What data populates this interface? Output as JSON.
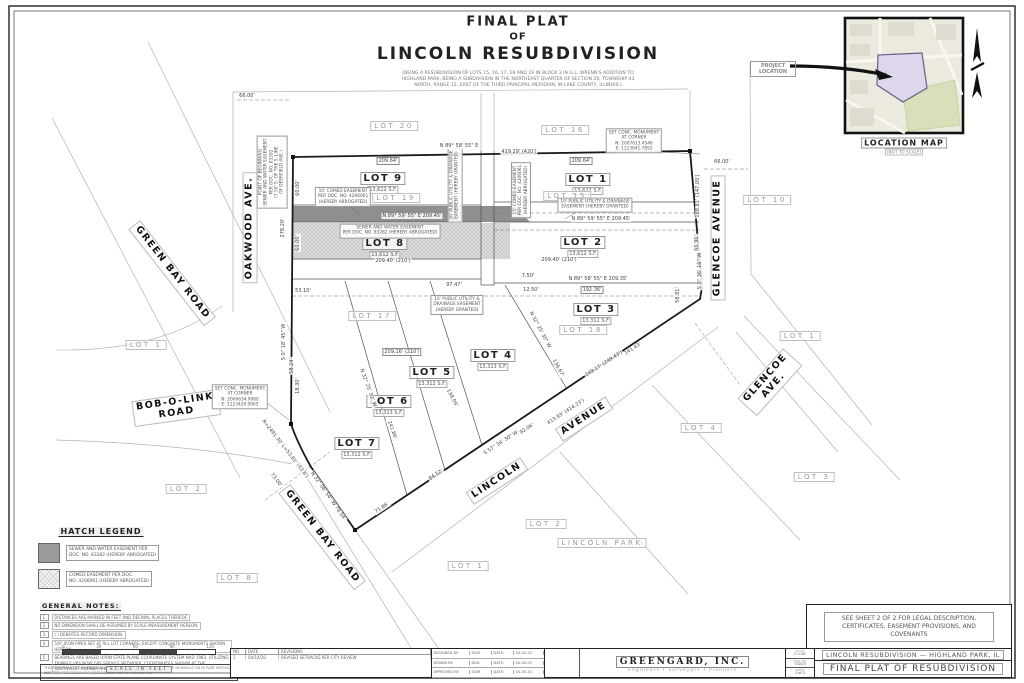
{
  "sheet": {
    "title_lines": [
      "FINAL PLAT",
      "OF",
      "LINCOLN RESUBDIVISION"
    ],
    "subtitle": "(BEING A RESUBDIVISION OF LOTS 15, 16, 17, 18 AND 19 IN BLOCK 3 IN G.L. WRENN'S ADDITION TO HIGHLAND PARK, BEING A SUBDIVISION IN THE NORTHEAST QUARTER OF SECTION 26, TOWNSHIP 43 NORTH, RANGE 12, EAST OF THE THIRD PRINCIPAL MERIDIAN, IN LAKE COUNTY, ILLINOIS.)"
  },
  "location_map": {
    "pointer": "PROJECT LOCATION",
    "caption": "LOCATION MAP",
    "scale_note": "(NOT TO SCALE)"
  },
  "plat": {
    "lots": [
      {
        "name": "LOT 9",
        "area": "13,622 S.F.",
        "x": 383,
        "y": 180
      },
      {
        "name": "LOT 1",
        "area": "13,622 S.F.",
        "x": 588,
        "y": 181
      },
      {
        "name": "LOT 8",
        "area": "13,612 S.F.",
        "x": 385,
        "y": 245
      },
      {
        "name": "LOT 2",
        "area": "13,612 S.F.",
        "x": 583,
        "y": 244
      },
      {
        "name": "LOT 3",
        "area": "13,312 S.F.",
        "x": 596,
        "y": 311
      },
      {
        "name": "LOT 4",
        "area": "13,313 S.F.",
        "x": 493,
        "y": 357
      },
      {
        "name": "LOT 5",
        "area": "13,312 S.F.",
        "x": 432,
        "y": 374
      },
      {
        "name": "LOT 6",
        "area": "13,313 S.F.",
        "x": 389,
        "y": 403
      },
      {
        "name": "LOT 7",
        "area": "13,312 S.F.",
        "x": 357,
        "y": 445
      }
    ],
    "old_lots": [
      {
        "t": "LOT 20",
        "x": 394,
        "y": 126
      },
      {
        "t": "LOT 16",
        "x": 565,
        "y": 130
      },
      {
        "t": "LOT 19",
        "x": 396,
        "y": 198
      },
      {
        "t": "LOT 15",
        "x": 567,
        "y": 196
      },
      {
        "t": "LOT 18",
        "x": 583,
        "y": 330
      },
      {
        "t": "LOT 17",
        "x": 372,
        "y": 316
      }
    ],
    "adjacent_lots": [
      {
        "t": "LOT 10",
        "x": 767,
        "y": 200
      },
      {
        "t": "LOT 1",
        "x": 800,
        "y": 336
      },
      {
        "t": "LOT 4",
        "x": 701,
        "y": 428
      },
      {
        "t": "LOT 3",
        "x": 814,
        "y": 477
      },
      {
        "t": "LOT 1",
        "x": 146,
        "y": 345
      },
      {
        "t": "LOT 2",
        "x": 186,
        "y": 489
      },
      {
        "t": "LOT 2",
        "x": 546,
        "y": 524
      },
      {
        "t": "LOT 1",
        "x": 468,
        "y": 566
      },
      {
        "t": "LOT 8",
        "x": 237,
        "y": 578
      },
      {
        "t": "LINCOLN  PARK",
        "x": 602,
        "y": 543
      }
    ],
    "streets": [
      {
        "lines": [
          "OAKWOOD AVE."
        ],
        "x": 250,
        "y": 228,
        "r": -90
      },
      {
        "lines": [
          "GREEN BAY ROAD"
        ],
        "x": 172,
        "y": 273,
        "r": 52
      },
      {
        "lines": [
          "BOB-O-LINK",
          "ROAD"
        ],
        "x": 176,
        "y": 408,
        "r": -8
      },
      {
        "lines": [
          "GREEN BAY ROAD"
        ],
        "x": 322,
        "y": 537,
        "r": 52
      },
      {
        "lines": [
          "LINCOLN"
        ],
        "x": 497,
        "y": 481,
        "r": -33
      },
      {
        "lines": [
          "AVENUE"
        ],
        "x": 584,
        "y": 419,
        "r": -33
      },
      {
        "lines": [
          "GLENCOE AVENUE"
        ],
        "x": 718,
        "y": 238,
        "r": -90
      },
      {
        "lines": [
          "GLENCOE",
          "AVE."
        ],
        "x": 770,
        "y": 382,
        "r": -48
      }
    ],
    "notes": [
      {
        "lines": [
          "10' COMED EASEMENT",
          "PER DOC. NO. 4206061",
          "(HEREBY ABROGATED)"
        ],
        "x": 343,
        "y": 197
      },
      {
        "lines": [
          "SEWER AND WATER EASEMENT",
          "PER DOC. NO. 83282 (HEREBY ABROGATED)"
        ],
        "x": 390,
        "y": 231
      },
      {
        "lines": [
          "15' COMED EASEMENT",
          "PER DOC. NO. 4206061",
          "(HEREBY ABROGATED)"
        ],
        "x": 521,
        "y": 190,
        "r": -90
      },
      {
        "lines": [
          "10' PUBLIC UTILITY & DRAINAGE",
          "EASEMENT (HEREBY GRANTED)"
        ],
        "x": 595,
        "y": 205
      },
      {
        "lines": [
          "10' PUBLIC UTILITY &",
          "DRAINAGE EASEMENT",
          "(HEREBY GRANTED)"
        ],
        "x": 457,
        "y": 305
      },
      {
        "lines": [
          "20' PUBLIC UTILITY & DRAINAGE",
          "EASEMENT (HEREBY GRANTED)"
        ],
        "x": 455,
        "y": 185,
        "r": -90
      },
      {
        "lines": [
          "SET CONC. MONUMENT",
          "AT CORNER",
          "N: 2007613.4546",
          "E: 1123941.7852"
        ],
        "x": 634,
        "y": 141
      },
      {
        "lines": [
          "SET CONC. MONUMENT",
          "AT CORNER",
          "N: 2006634.9060",
          "E: 1123420.0065"
        ],
        "x": 240,
        "y": 397
      },
      {
        "lines": [
          "POINT OF BEGINNING",
          "SEWER AND WATER EASEMENT",
          "PER DOC. NO. 83282",
          "(7.50' S. OF THE S. LINE",
          "OF DEERFIELD AVE.)"
        ],
        "x": 272,
        "y": 172,
        "r": -90
      }
    ],
    "dims": [
      {
        "t": "66.00'",
        "x": 247,
        "y": 96
      },
      {
        "t": "66.00'",
        "x": 722,
        "y": 162
      },
      {
        "t": "N 89° 58' 55\" E",
        "x": 459,
        "y": 146
      },
      {
        "t": "209.64'",
        "x": 388,
        "y": 161,
        "boxed": 1
      },
      {
        "t": "209.64'",
        "x": 581,
        "y": 161,
        "boxed": 1
      },
      {
        "t": "419.29' (420')",
        "x": 519,
        "y": 152
      },
      {
        "t": "N 89° 59' 55\" E   209.45'",
        "x": 412,
        "y": 216
      },
      {
        "t": "N 89° 59' 55\" E   209.45'",
        "x": 601,
        "y": 219
      },
      {
        "t": "209.40' (210')",
        "x": 393,
        "y": 261
      },
      {
        "t": "209.40' (210')",
        "x": 559,
        "y": 260
      },
      {
        "t": "N 89° 58' 55\" E   209.35'",
        "x": 598,
        "y": 279
      },
      {
        "t": "192.36'",
        "x": 592,
        "y": 290,
        "boxed": 1
      },
      {
        "t": "97.47'",
        "x": 454,
        "y": 285
      },
      {
        "t": "7.50'",
        "x": 528,
        "y": 276
      },
      {
        "t": "12.50'",
        "x": 531,
        "y": 290
      },
      {
        "t": "53.10'",
        "x": 303,
        "y": 291
      },
      {
        "t": "278.20'",
        "x": 283,
        "y": 228,
        "r": -90
      },
      {
        "t": "60.00'",
        "x": 298,
        "y": 188,
        "r": -90
      },
      {
        "t": "60.00'",
        "x": 298,
        "y": 243,
        "r": -90
      },
      {
        "t": "168.81' (147.05')",
        "x": 698,
        "y": 196,
        "r": -90
      },
      {
        "t": "60.90'",
        "x": 697,
        "y": 243,
        "r": -90
      },
      {
        "t": "S 0° 36' 16\" W",
        "x": 700,
        "y": 271,
        "r": -90
      },
      {
        "t": "58.81'",
        "x": 678,
        "y": 295,
        "r": -90
      },
      {
        "t": "S 0° 18' 45\" W",
        "x": 284,
        "y": 342,
        "r": -90
      },
      {
        "t": "58.24'",
        "x": 292,
        "y": 366,
        "r": -90
      },
      {
        "t": "18.30'",
        "x": 298,
        "y": 386,
        "r": -90
      },
      {
        "t": "R=2491.30'  L=53.81' (53.6')",
        "x": 285,
        "y": 449,
        "r": 52
      },
      {
        "t": "73.00'",
        "x": 276,
        "y": 480,
        "r": 52
      },
      {
        "t": "N 32° 06' 54\" W  78.54'",
        "x": 328,
        "y": 496,
        "r": 55
      },
      {
        "t": "S 57° 34' 30\" W",
        "x": 501,
        "y": 443,
        "r": -33
      },
      {
        "t": "413.93' (414.23')",
        "x": 566,
        "y": 412,
        "r": -33
      },
      {
        "t": "92.06'",
        "x": 527,
        "y": 429,
        "r": -33
      },
      {
        "t": "249.17' (249.43')",
        "x": 604,
        "y": 364,
        "r": -33
      },
      {
        "t": "141.43'",
        "x": 633,
        "y": 349,
        "r": -33
      },
      {
        "t": "209.16' (210')",
        "x": 402,
        "y": 352,
        "boxed": 1
      },
      {
        "t": "N 32° 25' 30\" W",
        "x": 540,
        "y": 330,
        "r": 62
      },
      {
        "t": "136.67'",
        "x": 558,
        "y": 368,
        "r": 62
      },
      {
        "t": "N 32° 25' 30\" W",
        "x": 368,
        "y": 388,
        "r": 70
      },
      {
        "t": "241.86'",
        "x": 392,
        "y": 430,
        "r": 70
      },
      {
        "t": "138.04'",
        "x": 452,
        "y": 398,
        "r": 62
      },
      {
        "t": "84.52'",
        "x": 436,
        "y": 475,
        "r": -33
      },
      {
        "t": "71.86'",
        "x": 382,
        "y": 508,
        "r": -33
      }
    ]
  },
  "hatch_legend": {
    "title": "HATCH LEGEND",
    "items": [
      {
        "swatch": "solid-gray",
        "l1": "SEWER AND WATER EASEMENT PER",
        "l2": "DOC. NO. 83282 (HEREBY ABROGATED)"
      },
      {
        "swatch": "crosshatch",
        "l1": "COMED EASEMENT PER DOC.",
        "l2": "NO. 4206061 (HEREBY ABROGATED)"
      }
    ]
  },
  "general_notes": {
    "title": "GENERAL NOTES:",
    "items": [
      {
        "n": "1.",
        "t": "DISTANCES ARE MARKED IN FEET AND DECIMAL PLACES THEREOF."
      },
      {
        "n": "2.",
        "t": "NO DIMENSION SHALL BE ASSUMED BY SCALE MEASUREMENT HEREON."
      },
      {
        "n": "3.",
        "t": "(    ) DENOTES RECORD DIMENSION."
      },
      {
        "n": "4.",
        "t": "5/8\" IRON PIPES SET AT ALL LOT CORNERS, EXCEPT CONCRETE MONUMENTS SHOWN HEREON."
      },
      {
        "n": "5.",
        "t": "BEARINGS ARE BASED UPON STATE PLANE COORDINATE SYSTEM NAD 1983, UTILIZING TRIMBLE VRS NOW GPS SERVICE NETWORK. COORDINATES SHOWN AT THE SOUTHWEST CORNER AND NORTHEAST CORNER."
      }
    ]
  },
  "scale_bar": {
    "ticks": [
      "0",
      "30",
      "60",
      "90",
      "120"
    ],
    "label": "SCALE  IN  FEET"
  },
  "copyright": "THIS PROPERTY OF GREENGARD, INC. AND ANY REPRODUCTION OR USE IN WHOLE OR IN PART WITHOUT WRITTEN PERMISSION OF GREENGARD, INC. IS PROHIBITED.",
  "revisions": {
    "headers": [
      "NO.",
      "DATE",
      "REVISIONS"
    ],
    "rows": [
      {
        "no": "1",
        "date": "04/14/20",
        "desc": "REVISED SETBACKS PER CITY REVIEW"
      }
    ]
  },
  "staff": [
    {
      "role": "DESIGNED BY:",
      "name": "DGM",
      "date_label": "DATE:",
      "date": "04-30-20"
    },
    {
      "role": "DRAWN BY:",
      "name": "DRD",
      "date_label": "DATE:",
      "date": "04-30-20"
    },
    {
      "role": "APPROVED BY:",
      "name": "DGM",
      "date_label": "DATE:",
      "date": "04-30-20"
    }
  ],
  "firm": {
    "name": "GREENGARD,  INC.",
    "tagline": "Engineers  •  Surveyors  •  Planners",
    "address": "611 Barclay Blvd., Suite 310, Lincolnshire, Illinois 60069-3623",
    "phone": "PHONE: 847-634-1901",
    "fax": "FAX: 847-634-1907",
    "email": "E-MAIL: INFO@GREENGARD-INC.COM",
    "registration": "IL REGISTRATION NO. 184-000882"
  },
  "title_info": {
    "scale_label": "SCALE:",
    "scale": "1\"=50'",
    "project_label": "PROJ. NO.",
    "project_no": "70223",
    "sheet_label": "SHEET",
    "sheet": "1 of 2"
  },
  "project": {
    "line1": "LINCOLN  RESUBDIVISION  —  HIGHLAND  PARK,  IL",
    "line2": "FINAL  PLAT  OF  RESUBDIVISION"
  },
  "sheet2_note": "SEE SHEET 2 OF 2 FOR LEGAL DESCRIPTION, CERTIFICATES, EASEMENT PROVISIONS, AND COVENANTS"
}
